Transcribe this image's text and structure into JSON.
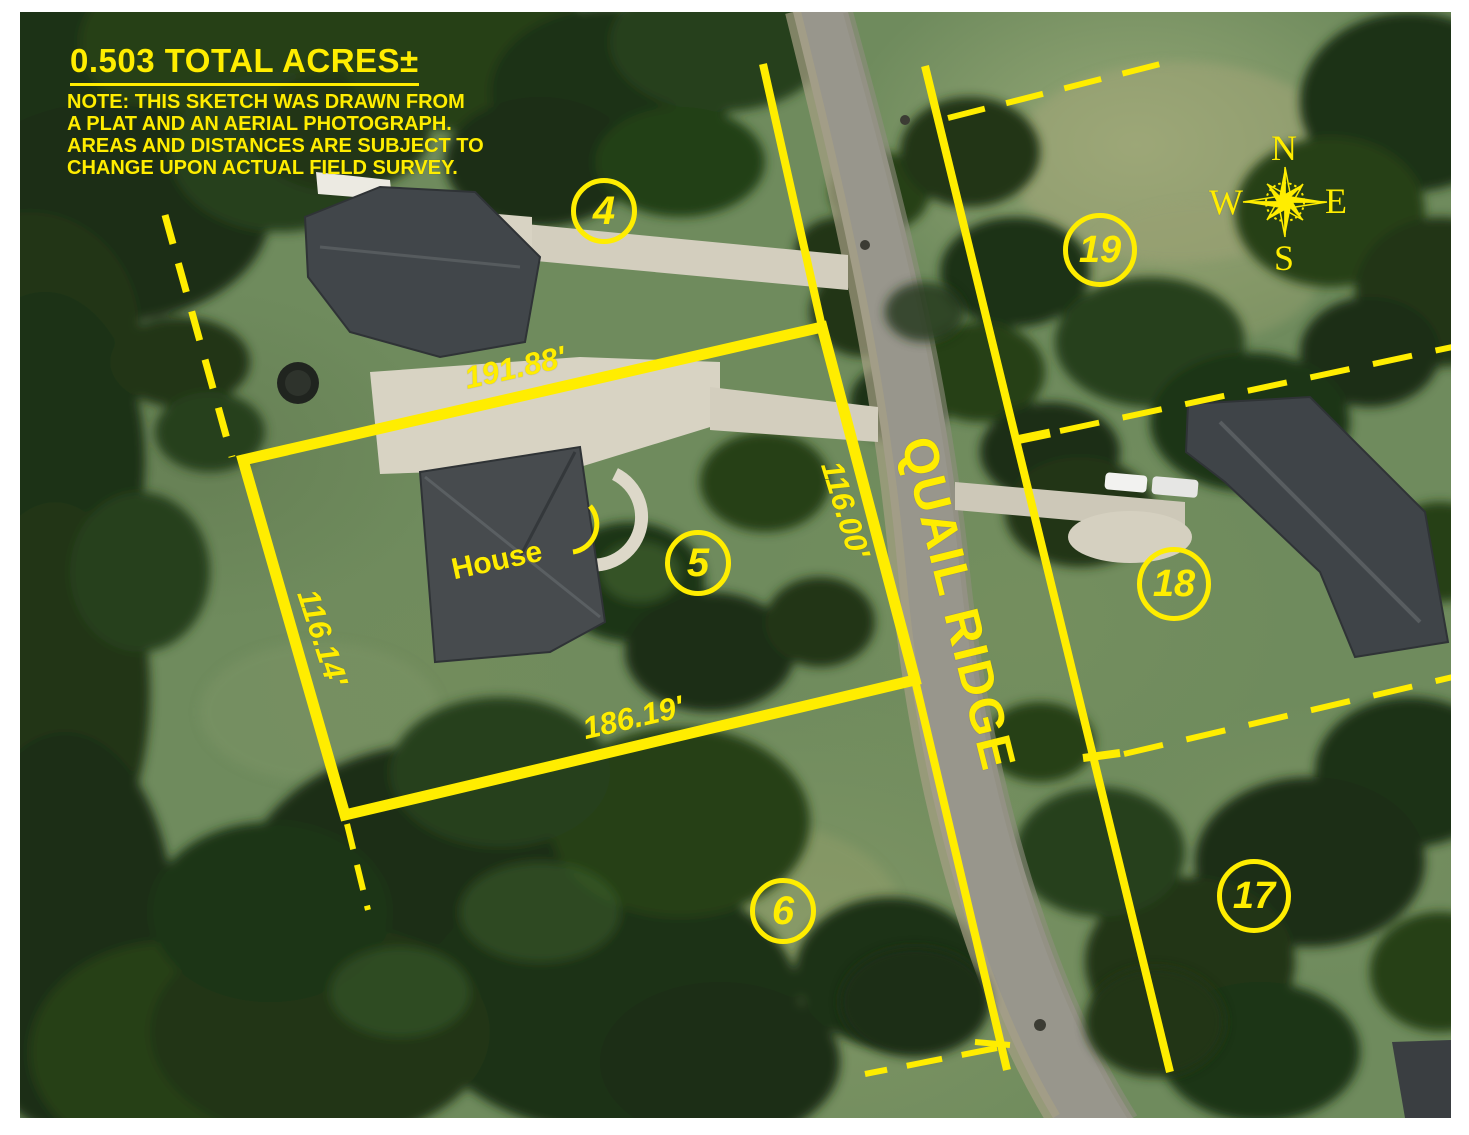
{
  "colors": {
    "accent": "#FFED00"
  },
  "header": {
    "title": "0.503 TOTAL ACRES±",
    "note_line1": "NOTE: THIS SKETCH WAS DRAWN FROM",
    "note_line2": "A PLAT AND AN AERIAL PHOTOGRAPH.",
    "note_line3": "AREAS AND DISTANCES ARE SUBJECT TO",
    "note_line4": "CHANGE UPON ACTUAL FIELD SURVEY."
  },
  "parcel": {
    "house_label": "House",
    "dimensions": {
      "north": "191.88'",
      "east": "116.00'",
      "south": "186.19'",
      "west": "116.14'"
    }
  },
  "road": {
    "name": "QUAIL RIDGE"
  },
  "lots": {
    "lot4": "4",
    "lot5": "5",
    "lot6": "6",
    "lot17": "17",
    "lot18": "18",
    "lot19": "19"
  },
  "compass": {
    "n": "N",
    "s": "S",
    "e": "E",
    "w": "W"
  }
}
